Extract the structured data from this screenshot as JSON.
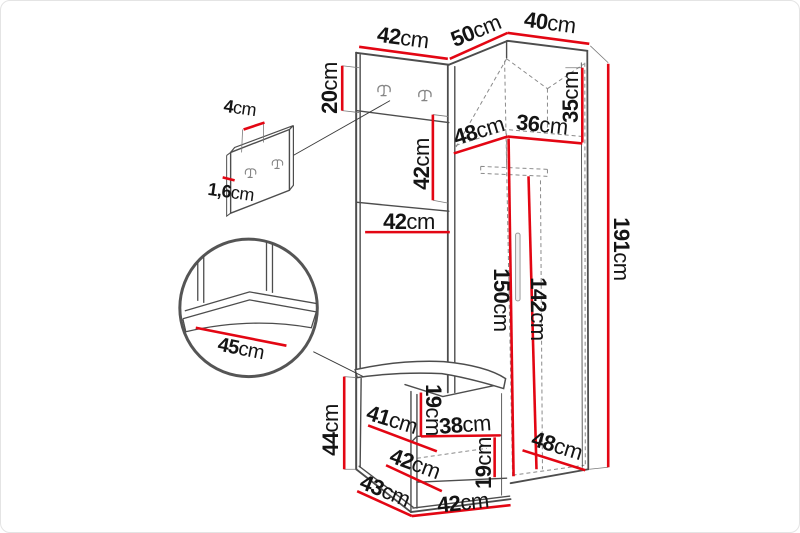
{
  "colors": {
    "dimension_line": "#e30613",
    "structure_line": "#4d4d4d",
    "hidden_line": "#8a8a8a",
    "label_text": "#141414"
  },
  "unit": "cm",
  "dims": {
    "width_top_panel": {
      "num": "42",
      "unit": "cm"
    },
    "width_top_left_wing": {
      "num": "50",
      "unit": "cm"
    },
    "width_top_right_wing": {
      "num": "40",
      "unit": "cm"
    },
    "height_hook_strip": {
      "num": "20",
      "unit": "cm"
    },
    "height_panel_upper": {
      "num": "42",
      "unit": "cm"
    },
    "depth_inner_left": {
      "num": "48",
      "unit": "cm"
    },
    "width_inner_right": {
      "num": "36",
      "unit": "cm"
    },
    "height_top_compartment": {
      "num": "35",
      "unit": "cm"
    },
    "width_panel_mid": {
      "num": "42",
      "unit": "cm"
    },
    "height_total": {
      "num": "191",
      "unit": "cm"
    },
    "height_interior_left": {
      "num": "150",
      "unit": "cm"
    },
    "height_interior_right": {
      "num": "142",
      "unit": "cm"
    },
    "height_bench": {
      "num": "44",
      "unit": "cm"
    },
    "depth_bench_top": {
      "num": "41",
      "unit": "cm"
    },
    "height_shoe_gap_upper": {
      "num": "19",
      "unit": "cm"
    },
    "width_shoe_shelf": {
      "num": "38",
      "unit": "cm"
    },
    "depth_bench_mid": {
      "num": "42",
      "unit": "cm"
    },
    "height_shoe_gap_lower": {
      "num": "19",
      "unit": "cm"
    },
    "depth_bottom_right": {
      "num": "48",
      "unit": "cm"
    },
    "depth_bench_bottom": {
      "num": "43",
      "unit": "cm"
    },
    "width_bench_bottom": {
      "num": "42",
      "unit": "cm"
    },
    "depth_seat_detail": {
      "num": "45",
      "unit": "cm"
    },
    "depth_hook_panel": {
      "num": "4",
      "unit": "cm"
    },
    "thickness_hook_panel": {
      "num": "1,6",
      "unit": "cm"
    }
  }
}
